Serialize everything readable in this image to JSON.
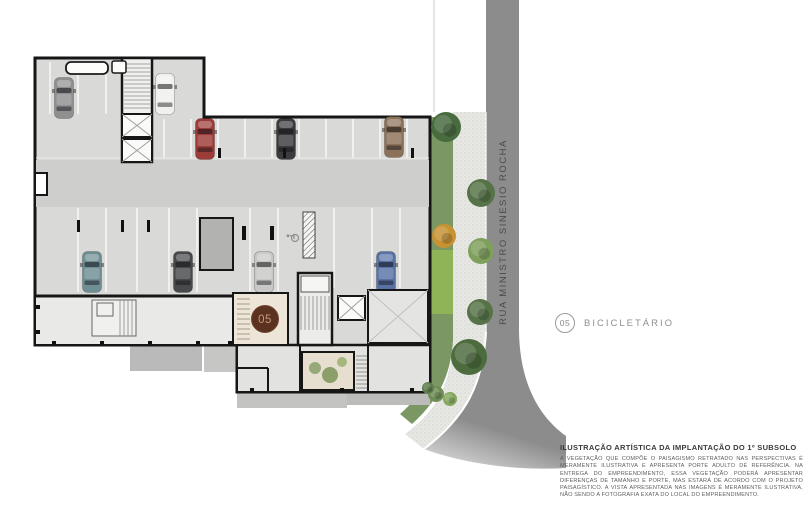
{
  "illustration": {
    "street_label": "RUA MINISTRO SINESIO ROCHA",
    "marker_number": "05",
    "colors": {
      "street": "#8c8c8c",
      "sidewalk": "#e7e7e4",
      "hedge": "#7b9763",
      "marker_fill": "#5a321f",
      "marker_ring": "#74462f",
      "marker_text": "#c59a7d",
      "wall": "#161616",
      "parking_floor": "#d9d9d7"
    },
    "cars": [
      {
        "x": 64,
        "y": 98,
        "color": "#8f8f8f"
      },
      {
        "x": 165,
        "y": 94,
        "color": "#f0f0ee"
      },
      {
        "x": 205,
        "y": 139,
        "color": "#9c3b38"
      },
      {
        "x": 286,
        "y": 139,
        "color": "#3b3b3d"
      },
      {
        "x": 394,
        "y": 137,
        "color": "#8b7158"
      },
      {
        "x": 92,
        "y": 272,
        "color": "#6e8e94"
      },
      {
        "x": 183,
        "y": 272,
        "color": "#47494b"
      },
      {
        "x": 264,
        "y": 272,
        "color": "#c8c8c6"
      },
      {
        "x": 386,
        "y": 272,
        "color": "#5872a6"
      }
    ],
    "trees": [
      {
        "x": 446,
        "y": 127,
        "r": 15,
        "color": "#486b40"
      },
      {
        "x": 481,
        "y": 193,
        "r": 14,
        "color": "#567348"
      },
      {
        "x": 444,
        "y": 236,
        "r": 12,
        "color": "#c79232"
      },
      {
        "x": 481,
        "y": 251,
        "r": 13,
        "color": "#7fa05c"
      },
      {
        "x": 480,
        "y": 312,
        "r": 13,
        "color": "#567348"
      },
      {
        "x": 469,
        "y": 357,
        "r": 18,
        "color": "#4c6c3e"
      },
      {
        "x": 436,
        "y": 394,
        "r": 8,
        "color": "#6f8e55"
      },
      {
        "x": 450,
        "y": 399,
        "r": 7,
        "color": "#86a85e"
      },
      {
        "x": 428,
        "y": 388,
        "r": 6,
        "color": "#5d7c4a"
      }
    ]
  },
  "legend": {
    "number": "05",
    "label": "BICICLETÁRIO"
  },
  "caption": {
    "title": "ILUSTRAÇÃO ARTÍSTICA DA IMPLANTAÇÃO DO 1º SUBSOLO",
    "disclaimer": "A VEGETAÇÃO QUE COMPÕE O PAISAGISMO RETRATADO NAS PERSPECTIVAS É MERAMENTE ILUSTRATIVA E APRESENTA PORTE ADULTO DE REFERÊNCIA. NA ENTREGA DO EMPREENDIMENTO, ESSA VEGETAÇÃO PODERÁ APRESENTAR DIFERENÇAS DE TAMANHO E PORTE, MAS ESTARÁ DE ACORDO COM O PROJETO PAISAGÍSTICO. A VISTA APRESENTADA NAS IMAGENS É MERAMENTE ILUSTRATIVA, NÃO SENDO A FOTOGRAFIA EXATA DO LOCAL DO EMPREENDIMENTO."
  }
}
